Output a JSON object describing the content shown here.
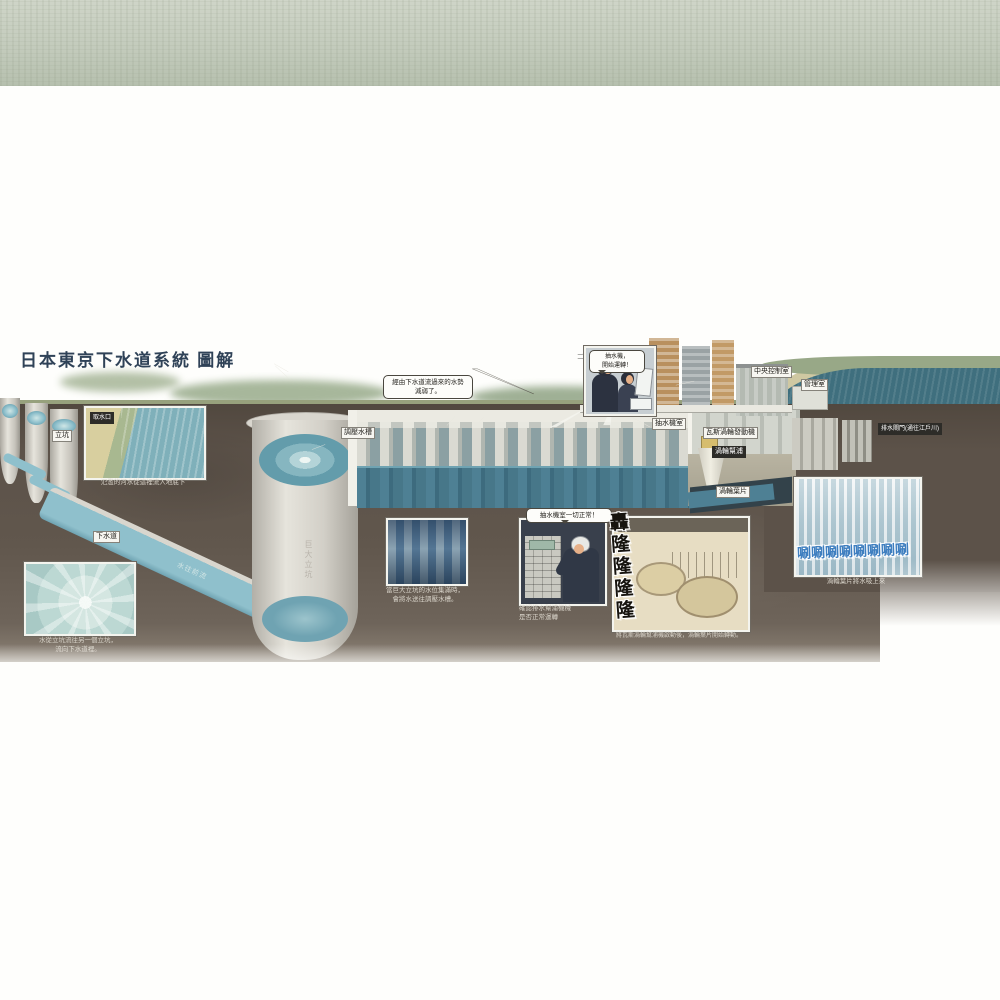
{
  "page": {
    "title": "日本東京下水道系統 圖解"
  },
  "labels": {
    "shaft": "立坑",
    "intake": "取水口",
    "sewer": "下水道",
    "giant_shaft": "巨大立坑",
    "flow_direction": "水往前流",
    "pressure_tank": "調壓水槽",
    "pump_room": "抽水機室",
    "gas_turbine": "瓦斯渦輪發動機",
    "turbine_pump": "渦輪幫浦",
    "turbine_blade": "渦輪葉片",
    "control_center": "中央控制室",
    "admin_office": "管理室",
    "drain_gate": "排水閘門(通往江戶川)"
  },
  "speech": {
    "weakened": [
      "經由下水道流過來的水勢",
      "減弱了。"
    ],
    "start_pump": [
      "抽水機，",
      "開始運轉！"
    ],
    "all_normal": "抽水機室一切正常！"
  },
  "captions": {
    "intake": "氾濫的河水從這裡流入地底下",
    "shaft_flow": [
      "水從立坑流往另一個立坑，",
      "流向下水道裡。"
    ],
    "tank_fill": [
      "當巨大立坑的水位集滿時，",
      "會將水送往調壓水槽。"
    ],
    "check": [
      "確認排水幫浦機械",
      "是否正常運轉"
    ],
    "turbine_start": "將瓦斯渦輪幫浦機啟動後，渦輪葉片開始轉動。",
    "suction": "渦輪葉片將水吸上來"
  },
  "sfx": {
    "rumble": "轟隆隆隆隆",
    "swish": "唰唰唰唰唰唰唰唰"
  },
  "colors": {
    "earth": "#5c5249",
    "sky": "#c6cec0",
    "water": "#8fc0cc",
    "deep_water": "#4e8094",
    "river": "#3f6f7e",
    "title_ink": "#2f4257",
    "sfx_blue": "#3f7fc0"
  }
}
